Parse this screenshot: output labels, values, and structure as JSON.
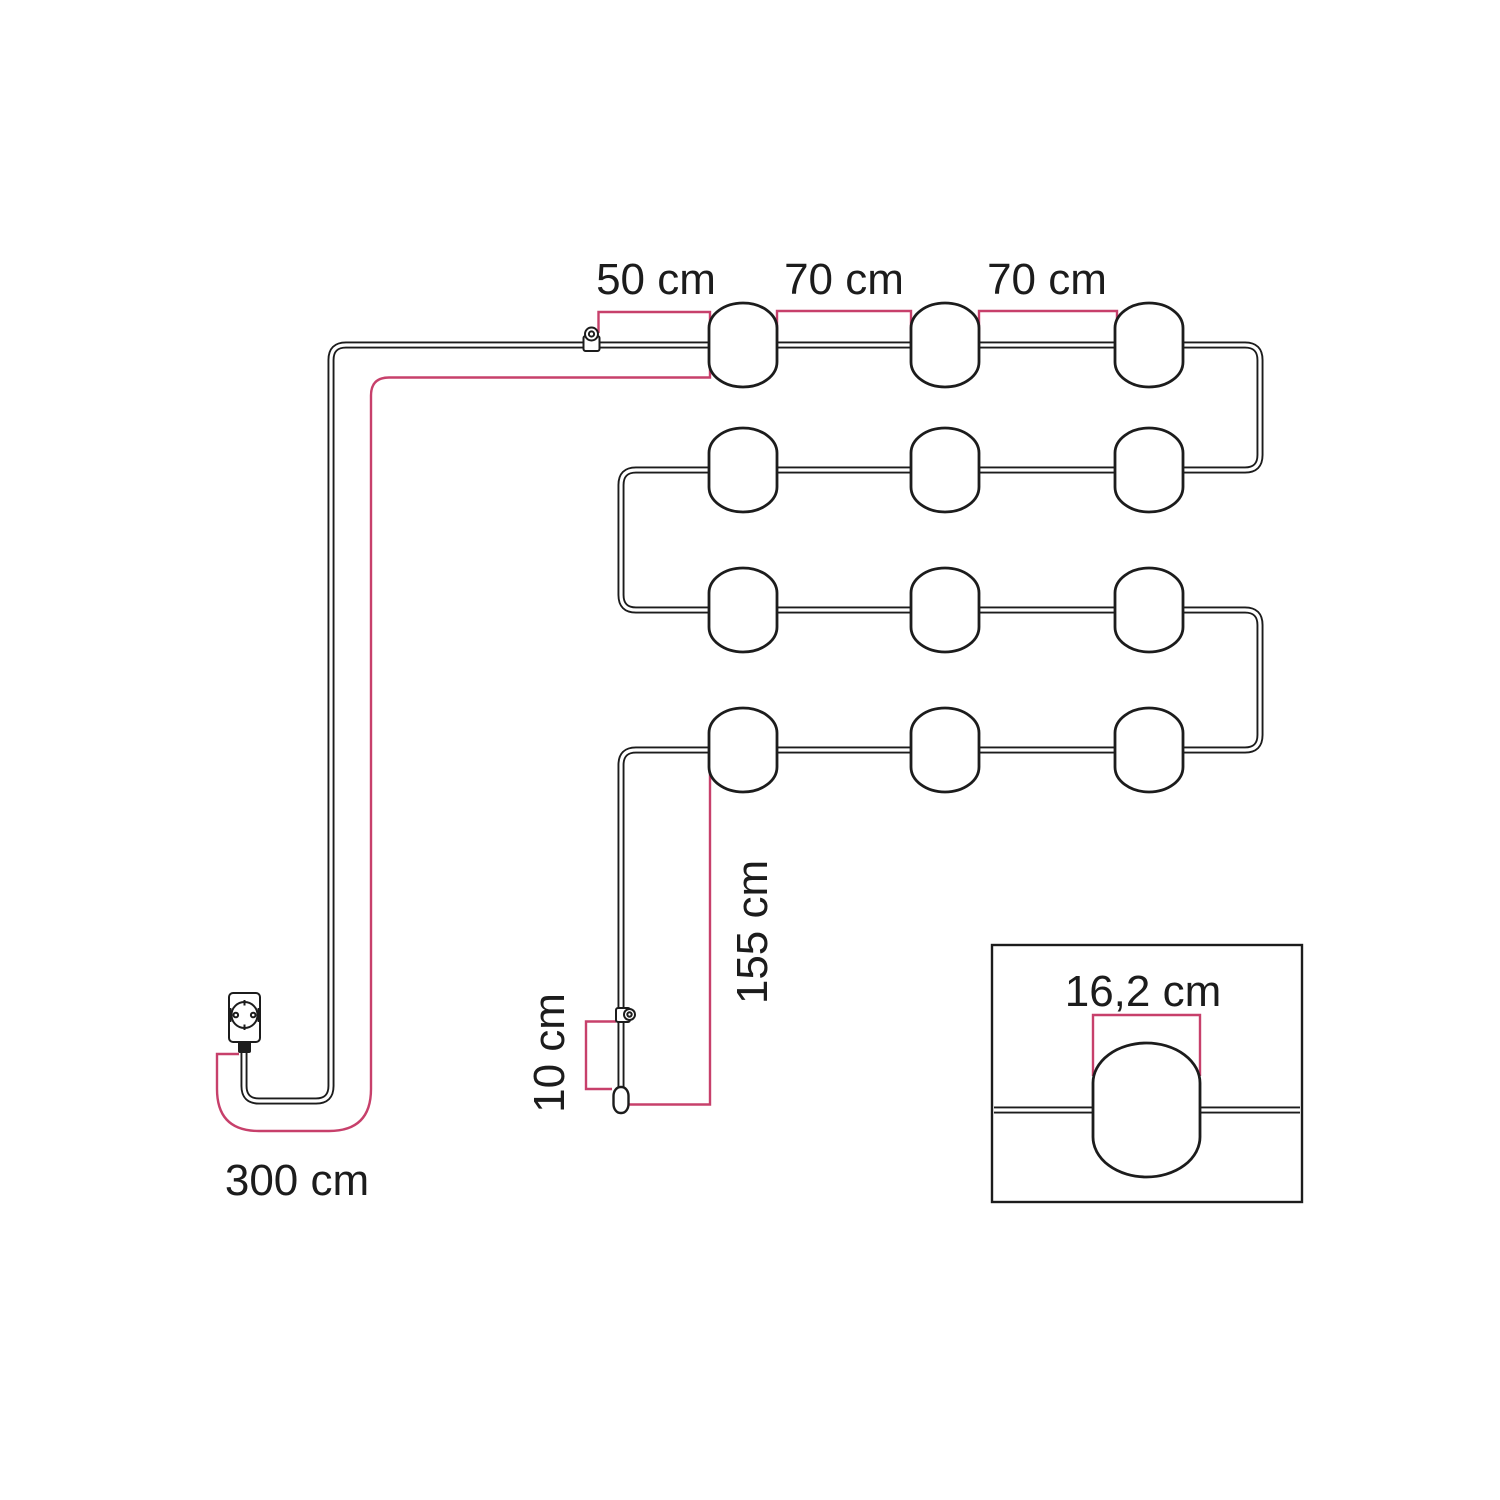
{
  "diagram": {
    "type": "string-light-measurement-diagram",
    "colors": {
      "ink": "#1c1c1c",
      "accent": "#c7406b",
      "paper": "#ffffff"
    },
    "lamps": {
      "count": 12,
      "rows": 4,
      "per_row": 3
    },
    "labels": {
      "lead_to_first_lamp": "50 cm",
      "spacing_1": "70 cm",
      "spacing_2": "70 cm",
      "power_cord": "300 cm",
      "end_tail": "155 cm",
      "tail_tip": "10 cm",
      "lamp_width_detail": "16,2 cm"
    },
    "icons": {
      "plug": "schuko-plug-icon",
      "hook_top": "eyelet-hook-icon",
      "hook_tail": "eyelet-hook-icon",
      "end_cap": "cable-end-cap-icon",
      "break_mark": "cable-break-mark-icon"
    }
  }
}
